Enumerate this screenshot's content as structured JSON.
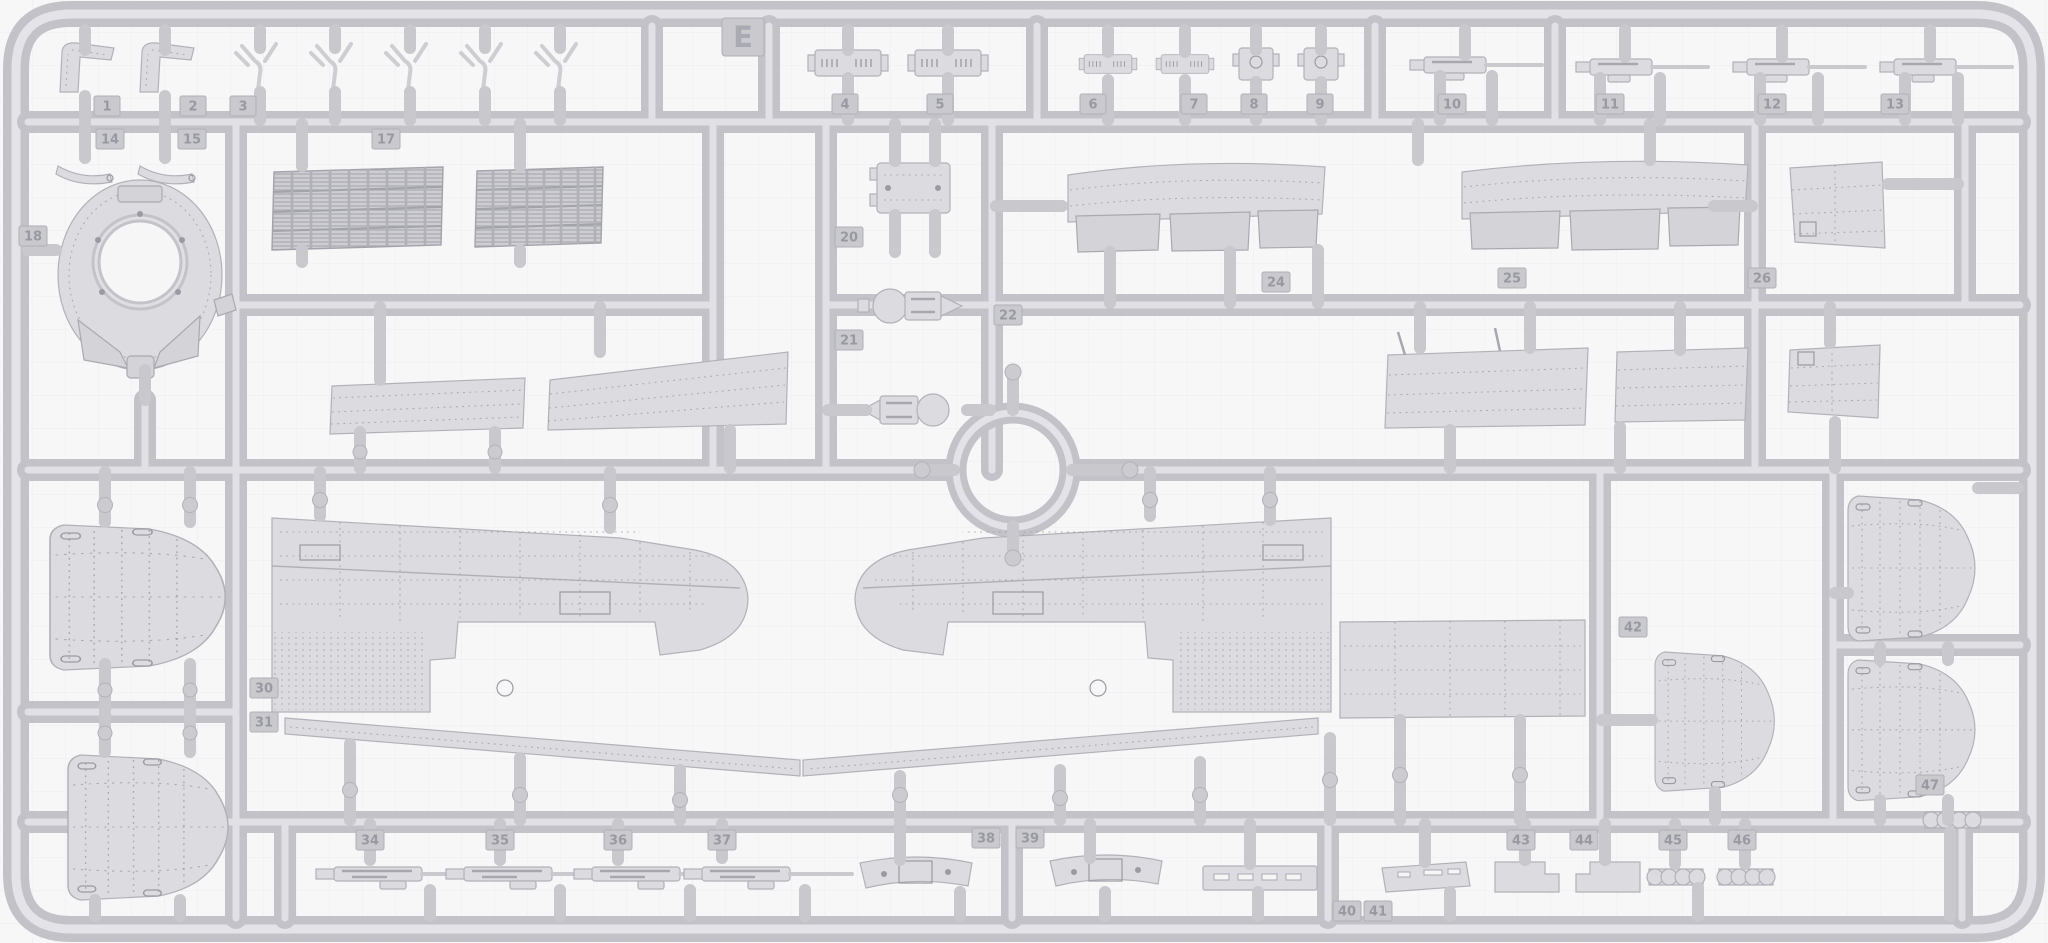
{
  "sprue": {
    "letter": "E",
    "subject": "injection-molded model kit sprue with aircraft parts",
    "material_color": "#dcdce0",
    "runner_color": "#c2c2c8",
    "background_color": "#f7f7f8"
  },
  "part_numbers": {
    "p1": "1",
    "p2": "2",
    "p3": "3",
    "p4": "4",
    "p5": "5",
    "p6": "6",
    "p7": "7",
    "p8": "8",
    "p9": "9",
    "p10": "10",
    "p11": "11",
    "p12": "12",
    "p13": "13",
    "p14": "14",
    "p15": "15",
    "p17": "17",
    "p18": "18",
    "p20": "20",
    "p21": "21",
    "p22": "22",
    "p24": "24",
    "p25": "25",
    "p26": "26",
    "p30": "30",
    "p31": "31",
    "p34": "34",
    "p35": "35",
    "p36": "36",
    "p37": "37",
    "p38": "38",
    "p39": "39",
    "p40": "40",
    "p41": "41",
    "p42": "42",
    "p43": "43",
    "p44": "44",
    "p45": "45",
    "p46": "46",
    "p47": "47"
  }
}
